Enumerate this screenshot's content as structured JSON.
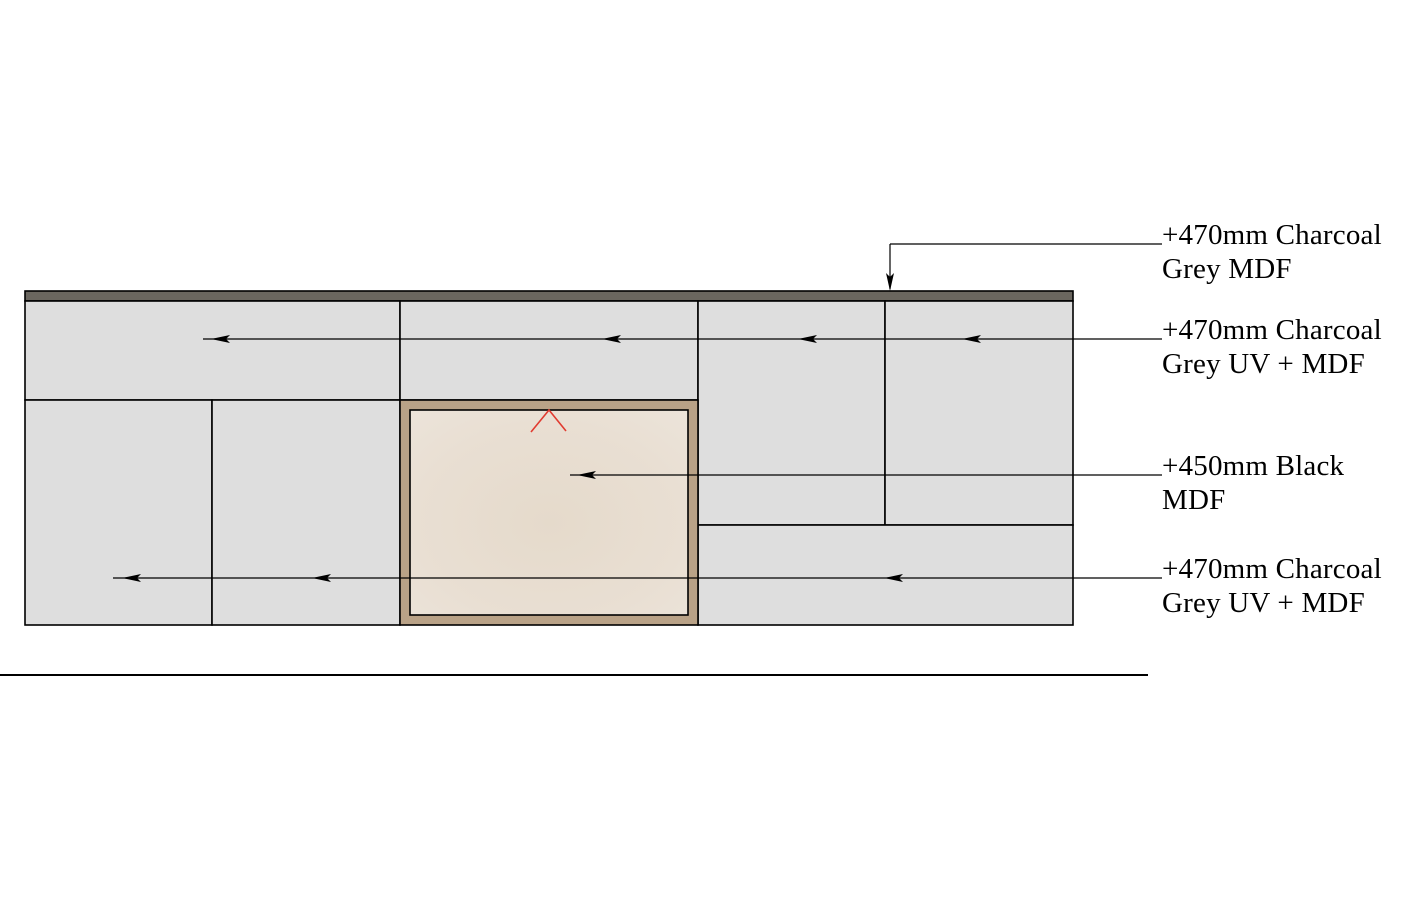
{
  "figure": {
    "kind": "joinery-elevation-drawing"
  },
  "colors": {
    "background": "#ffffff",
    "line_black": "#000000",
    "panel_grey": "#dedede",
    "top_strip": "#6a665f",
    "frame_tan": "#b9a287",
    "beige_center": "#e5dacb",
    "beige_mid": "#e9dfd3",
    "beige_edge": "#ece4da",
    "marker_red": "#e13b30"
  },
  "annotations": [
    {
      "name": "note-top-strip",
      "line1": "+470mm Charcoal",
      "line2": "Grey MDF",
      "full": "+470mm Charcoal Grey MDF",
      "leader_y": 244
    },
    {
      "name": "note-upper-band",
      "line1": "+470mm Charcoal",
      "line2": "Grey UV + MDF",
      "full": "+470mm Charcoal Grey UV + MDF",
      "leader_y": 339
    },
    {
      "name": "note-black-mdf",
      "line1": "+450mm Black",
      "line2": "MDF",
      "full": "+450mm Black MDF",
      "leader_y": 475
    },
    {
      "name": "note-lower-band",
      "line1": "+470mm Charcoal",
      "line2": "Grey UV + MDF",
      "full": "+470mm Charcoal Grey UV + MDF",
      "leader_y": 578
    }
  ],
  "panels": [
    {
      "name": "top-mdf-strip",
      "x": 25,
      "y": 291,
      "w": 1048,
      "h": 10,
      "fill": "top_strip"
    },
    {
      "name": "upper-left-door",
      "x": 25,
      "y": 301,
      "w": 375,
      "h": 99,
      "fill": "panel_grey"
    },
    {
      "name": "upper-middle-door",
      "x": 400,
      "y": 301,
      "w": 298,
      "h": 99,
      "fill": "panel_grey"
    },
    {
      "name": "right-tall-door-1",
      "x": 698,
      "y": 301,
      "w": 187,
      "h": 224,
      "fill": "panel_grey"
    },
    {
      "name": "right-tall-door-2",
      "x": 885,
      "y": 301,
      "w": 188,
      "h": 224,
      "fill": "panel_grey"
    },
    {
      "name": "lower-left-door-1",
      "x": 25,
      "y": 400,
      "w": 187,
      "h": 225,
      "fill": "panel_grey"
    },
    {
      "name": "lower-left-door-2",
      "x": 212,
      "y": 400,
      "w": 188,
      "h": 225,
      "fill": "panel_grey"
    },
    {
      "name": "lower-right-door",
      "x": 698,
      "y": 525,
      "w": 375,
      "h": 100,
      "fill": "panel_grey"
    },
    {
      "name": "appliance-frame",
      "x": 400,
      "y": 400,
      "w": 298,
      "h": 225,
      "fill": "frame_tan"
    },
    {
      "name": "appliance-recess",
      "x": 410,
      "y": 410,
      "w": 278,
      "h": 205,
      "fill": "beige_gradient"
    }
  ],
  "leaders": [
    {
      "name": "leader-top-strip",
      "y": 244,
      "x_start": 890,
      "x_end": 1162,
      "arrows": [],
      "drop": {
        "x": 890,
        "y_from": 244,
        "y_to": 291
      }
    },
    {
      "name": "leader-upper-band",
      "y": 339,
      "x_start": 203,
      "x_end": 1162,
      "arrows": [
        211,
        602,
        798,
        962
      ]
    },
    {
      "name": "leader-black-mdf",
      "y": 475,
      "x_start": 570,
      "x_end": 1162,
      "arrows": [
        577
      ]
    },
    {
      "name": "leader-lower-band",
      "y": 578,
      "x_start": 113,
      "x_end": 1162,
      "arrows": [
        122,
        312,
        884
      ]
    }
  ],
  "marker": {
    "name": "door-swing-chevron",
    "points": [
      [
        531,
        432
      ],
      [
        549,
        410
      ],
      [
        566,
        431
      ]
    ],
    "color": "marker_red"
  },
  "ground_line": {
    "x1": 0,
    "x2": 1148,
    "y": 675,
    "width": 2
  }
}
